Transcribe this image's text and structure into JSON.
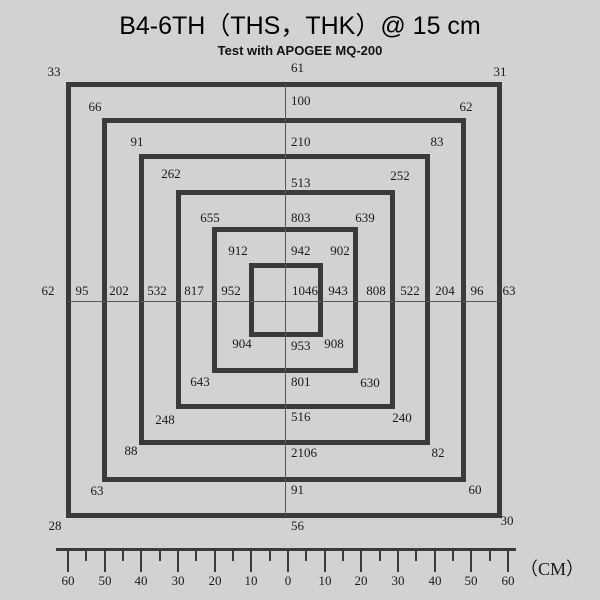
{
  "colors": {
    "background": "#d2d2d2",
    "square_line": "#3a3a3a",
    "axis_line": "#585858",
    "text": "#1a1a1a"
  },
  "chart_data": {
    "type": "heatmap",
    "title": "B4-6TH（THS，THK）@ 15 cm",
    "subtitle": "Test with APOGEE MQ-200",
    "description": "Light measurement values arranged on concentric square rings; readings at corners and edge midpoints of each ring plus the center.",
    "center_value": 1046,
    "rings": [
      {
        "radius_cm": 60,
        "top_left": 33,
        "top": 61,
        "top_right": 31,
        "left": 62,
        "right": 63,
        "bottom_left": 28,
        "bottom": 56,
        "bottom_right": 30
      },
      {
        "radius_cm": 50,
        "top_left": 66,
        "top": 100,
        "top_right": 62,
        "left": 95,
        "right": 96,
        "bottom_left": 63,
        "bottom": 91,
        "bottom_right": 60
      },
      {
        "radius_cm": 40,
        "top_left": 91,
        "top": 210,
        "top_right": 83,
        "left": 202,
        "right": 204,
        "bottom_left": 88,
        "bottom": 2106,
        "bottom_right": 82
      },
      {
        "radius_cm": 30,
        "top_left": 262,
        "top": 513,
        "top_right": 252,
        "left": 532,
        "right": 522,
        "bottom_left": 248,
        "bottom": 516,
        "bottom_right": 240
      },
      {
        "radius_cm": 20,
        "top_left": 655,
        "top": 803,
        "top_right": 639,
        "left": 817,
        "right": 808,
        "bottom_left": 643,
        "bottom": 801,
        "bottom_right": 630
      },
      {
        "radius_cm": 10,
        "top_left": 912,
        "top": 942,
        "top_right": 902,
        "left": 952,
        "right": 943,
        "bottom_left": 904,
        "bottom": 953,
        "bottom_right": 908
      }
    ],
    "x_axis": {
      "unit_label": "（CM）",
      "tick_step_cm": 10,
      "range_cm": [
        -60,
        60
      ],
      "tick_labels": [
        60,
        50,
        40,
        30,
        20,
        10,
        0,
        10,
        20,
        30,
        40,
        50,
        60
      ]
    },
    "legend": "none",
    "grid": "center crosshair lines only"
  }
}
